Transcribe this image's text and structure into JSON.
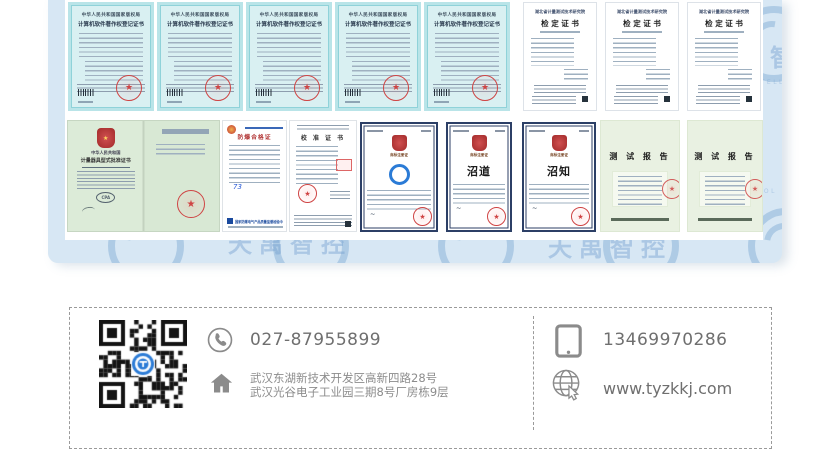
{
  "watermark": {
    "text": "天禹智控",
    "caption": "TIANYU INTELLIGENT CONTROL"
  },
  "certificates": {
    "row1": [
      {
        "header": "中华人民共和国国家版权局",
        "title": "计算机软件著作权登记证书"
      },
      {
        "header": "中华人民共和国国家版权局",
        "title": "计算机软件著作权登记证书"
      },
      {
        "header": "中华人民共和国国家版权局",
        "title": "计算机软件著作权登记证书"
      },
      {
        "header": "中华人民共和国国家版权局",
        "title": "计算机软件著作权登记证书"
      },
      {
        "header": "中华人民共和国国家版权局",
        "title": "计算机软件著作权登记证书"
      },
      {
        "org": "湖北省计量测试技术研究院",
        "title": "检 定 证 书"
      },
      {
        "org": "湖北省计量测试技术研究院",
        "title": "检 定 证 书"
      },
      {
        "org": "湖北省计量测试技术研究院",
        "title": "检 定 证 书"
      }
    ],
    "row2": [
      {
        "country": "中华人民共和国",
        "title": "计量器具型式批准证书",
        "cpa": "CPA"
      },
      {
        "title": "防爆合格证",
        "footer": "国家防爆电气产品质量监督检验中心",
        "signature": "73"
      },
      {
        "title": "校 准 证 书"
      },
      {
        "subtitle": "商标注册证"
      },
      {
        "subtitle": "商标注册证",
        "mark": "沼道"
      },
      {
        "subtitle": "商标注册证",
        "mark": "沼知"
      },
      {
        "title": "测 试 报 告"
      },
      {
        "title": "测 试 报 告"
      }
    ]
  },
  "contact": {
    "phone": "027-87955899",
    "mobile": "13469970286",
    "website": "www.tyzkkj.com",
    "address_line1": "武汉东湖新技术开发区高新四路28号",
    "address_line2": "武汉光谷电子工业园三期8号厂房栋9层"
  }
}
